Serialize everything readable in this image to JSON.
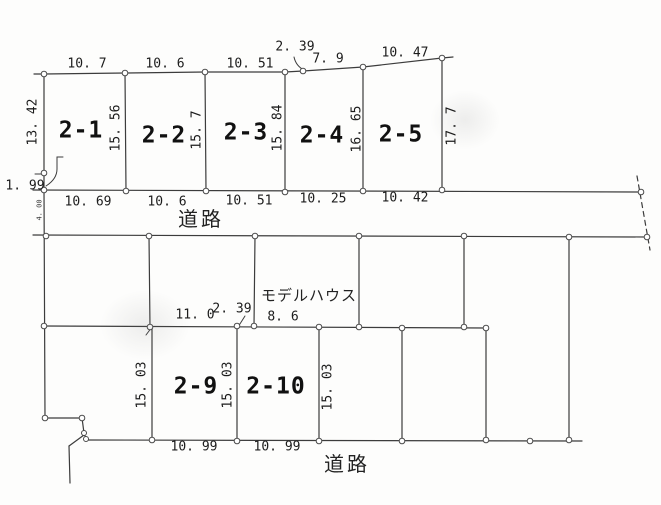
{
  "top_row": {
    "plot_labels": [
      "2-1",
      "2-2",
      "2-3",
      "2-4",
      "2-5"
    ],
    "top_dims": [
      "10. 7",
      "10. 6",
      "10. 51",
      "2. 39",
      "7. 9",
      "10. 47"
    ],
    "bottom_dims": [
      "10. 69",
      "10. 6",
      "10. 51",
      "10. 25",
      "10. 42"
    ],
    "divider_dims": [
      "13. 42",
      "15. 56",
      "15. 7",
      "15. 84",
      "16. 65",
      "17. 7"
    ],
    "left_remainder_dim": "1. 99"
  },
  "roads": {
    "upper_label": "道路",
    "lower_label": "道路",
    "upper_width_dim": "4. 00"
  },
  "middle_row": {
    "model_house_label": "モデルハウス",
    "bottom_dims": [
      "11. 0",
      "2. 39",
      "8. 6"
    ]
  },
  "bottom_row": {
    "plot_labels": [
      "2-9",
      "2-10"
    ],
    "divider_dims": [
      "15. 03",
      "15. 03",
      "15. 03"
    ],
    "bottom_dims": [
      "10. 99",
      "10. 99"
    ]
  }
}
